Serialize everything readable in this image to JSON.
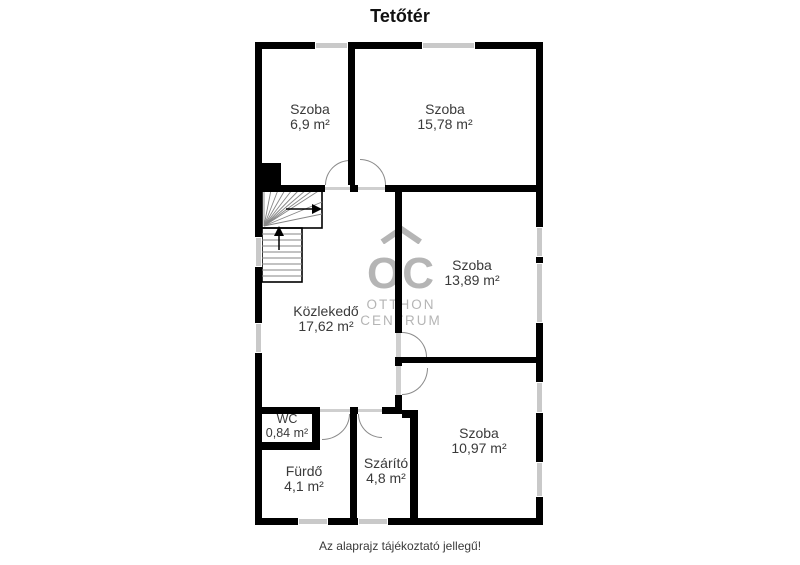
{
  "title": "Tetőtér",
  "footer": "Az alaprajz tájékoztató jellegű!",
  "watermark": {
    "abbr": "OC",
    "line1": "OTTHON",
    "line2": "CENTRUM"
  },
  "rooms": [
    {
      "name": "Szoba",
      "area": "6,9 m²"
    },
    {
      "name": "Szoba",
      "area": "15,78 m²"
    },
    {
      "name": "Szoba",
      "area": "13,89 m²"
    },
    {
      "name": "Közlekedő",
      "area": "17,62 m²"
    },
    {
      "name": "Szoba",
      "area": "10,97 m²"
    },
    {
      "name": "WC",
      "area": "0,84 m²"
    },
    {
      "name": "Fürdő",
      "area": "4,1 m²"
    },
    {
      "name": "Szárító",
      "area": "4,8 m²"
    }
  ],
  "colors": {
    "wall": "#000000",
    "window": "#c9c9c9",
    "watermark": "#b5b5b5",
    "label_text": "#3a3a3a"
  }
}
